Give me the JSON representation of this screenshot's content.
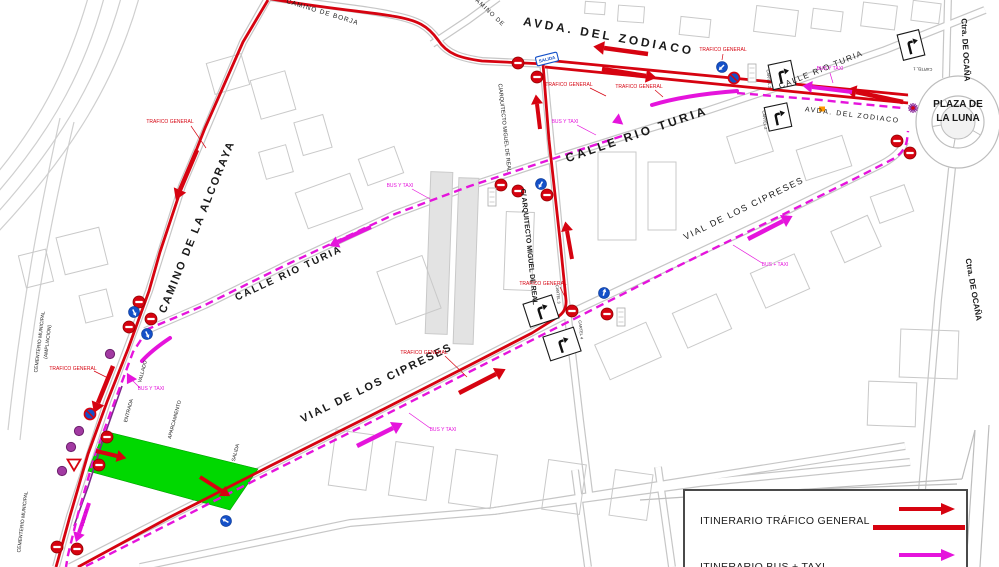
{
  "colors": {
    "red": "#d60310",
    "magenta": "#e514dc",
    "green": "#00d800",
    "purple": "#8a2a9a",
    "blue": "#1450c8",
    "black": "#1a1a1a"
  },
  "legend": {
    "general_label": "ITINERARIO TRÁFICO GENERAL",
    "bus_label": "ITINERARIO BUS + TAXI"
  },
  "street_labels": [
    {
      "t": "CAMINO DE BORJA",
      "x": 322,
      "y": 14,
      "r": 17,
      "s": 6.5,
      "ls": 1
    },
    {
      "t": "CAMINO DE",
      "x": 487,
      "y": 12,
      "r": 43,
      "s": 6,
      "ls": 1
    },
    {
      "t": "AVDA.  DEL  ZODIACO",
      "x": 608,
      "y": 40,
      "r": 10,
      "s": 12,
      "ls": 3,
      "b": 1
    },
    {
      "t": "AVDA.  DEL  ZODIACO",
      "x": 852,
      "y": 117,
      "r": 7,
      "s": 7,
      "ls": 1.5
    },
    {
      "t": "CALLE  RIO  TURIA",
      "x": 638,
      "y": 138,
      "r": -19,
      "s": 12,
      "ls": 3,
      "b": 1
    },
    {
      "t": "CALLE  RIO  TURIA",
      "x": 290,
      "y": 276,
      "r": -25,
      "s": 10,
      "ls": 2,
      "b": 1
    },
    {
      "t": "CALLE  RIO  TURIA",
      "x": 822,
      "y": 72,
      "r": -22,
      "s": 8,
      "ls": 1.5
    },
    {
      "t": "C/ARQUITECTO MIGUEL DE REAL",
      "x": 503,
      "y": 128,
      "r": 84,
      "s": 5.5
    },
    {
      "t": "C/ ARQUITECTO  MIGUEL  DE  REAL",
      "x": 527,
      "y": 247,
      "r": 84,
      "s": 7,
      "b": 1
    },
    {
      "t": "CAMINO  DE  LA  ALCORAYA",
      "x": 200,
      "y": 228,
      "r": -68,
      "s": 11,
      "ls": 2,
      "b": 1
    },
    {
      "t": "VIAL  DE  LOS  CIPRESES",
      "x": 378,
      "y": 386,
      "r": -26,
      "s": 11,
      "ls": 2,
      "b": 1
    },
    {
      "t": "VIAL  DE  LOS  CIPRESES",
      "x": 745,
      "y": 211,
      "r": -26,
      "s": 9,
      "ls": 1.5
    },
    {
      "t": "PLAZA DE",
      "x": 958,
      "y": 107,
      "s": 10,
      "b": 1
    },
    {
      "t": "LA LUNA",
      "x": 958,
      "y": 121,
      "s": 10,
      "b": 1
    },
    {
      "t": "Ctra.  DE  OCAÑA",
      "x": 963,
      "y": 50,
      "r": 87,
      "s": 8,
      "b": 1
    },
    {
      "t": "Ctra.  DE  OCAÑA",
      "x": 971,
      "y": 290,
      "r": 80,
      "s": 8,
      "b": 1
    },
    {
      "t": "CEMENTERIO MUNICIPAL",
      "x": 41,
      "y": 342,
      "r": -83,
      "s": 5
    },
    {
      "t": "(AMPLIACION)",
      "x": 49,
      "y": 342,
      "r": -83,
      "s": 5
    },
    {
      "t": "CEMENTERIO MUNICIPAL",
      "x": 24,
      "y": 522,
      "r": -83,
      "s": 5
    },
    {
      "t": "ENTRADA",
      "x": 130,
      "y": 411,
      "r": -75,
      "s": 5
    },
    {
      "t": "APARCAMIENTO",
      "x": 176,
      "y": 420,
      "r": -75,
      "s": 5
    },
    {
      "t": "SALIDA",
      "x": 237,
      "y": 453,
      "r": -75,
      "s": 5
    },
    {
      "t": "VALLADO",
      "x": 144,
      "y": 372,
      "r": -75,
      "s": 5
    },
    {
      "t": "VUELTA",
      "x": 86,
      "y": 518,
      "r": -75,
      "s": 5,
      "c": "#cc00cc"
    }
  ],
  "traffic_labels": [
    {
      "t": "TRAFICO GENERAL",
      "x": 170,
      "y": 123,
      "leader": [
        191,
        126,
        206,
        148
      ]
    },
    {
      "t": "TRAFICO GENERAL",
      "x": 569,
      "y": 86,
      "leader": [
        590,
        88,
        606,
        96
      ]
    },
    {
      "t": "TRAFICO GENERAL",
      "x": 639,
      "y": 88,
      "leader": [
        655,
        90,
        663,
        97
      ]
    },
    {
      "t": "TRAFICO GENERAL",
      "x": 723,
      "y": 51,
      "leader": [
        723,
        54,
        722,
        60
      ]
    },
    {
      "t": "TRAFICO GENERAL",
      "x": 424,
      "y": 354,
      "leader": [
        445,
        356,
        467,
        377
      ]
    },
    {
      "t": "TRAFICO GENERAL",
      "x": 543,
      "y": 285,
      "leader": [
        560,
        287,
        566,
        299
      ]
    },
    {
      "t": "TRAFICO GENERAL",
      "x": 73,
      "y": 370,
      "leader": [
        94,
        371,
        110,
        379
      ]
    }
  ],
  "bus_labels": [
    {
      "t": "BUS Y TAXI",
      "x": 565,
      "y": 123,
      "leader": [
        577,
        125,
        596,
        135
      ]
    },
    {
      "t": "BUS Y TAXI",
      "x": 400,
      "y": 187,
      "leader": [
        412,
        189,
        430,
        199
      ]
    },
    {
      "t": "BUS Y TAXI",
      "x": 151,
      "y": 390,
      "leader": [
        140,
        388,
        130,
        378
      ]
    },
    {
      "t": "BUS Y TAXI",
      "x": 443,
      "y": 431,
      "leader": [
        430,
        428,
        409,
        413
      ]
    },
    {
      "t": "BUS + TAXI",
      "x": 775,
      "y": 266,
      "leader": [
        762,
        263,
        733,
        245
      ]
    },
    {
      "t": "BUS Y TAXI",
      "x": 830,
      "y": 70,
      "leader": [
        830,
        73,
        833,
        83
      ]
    }
  ],
  "routes_red": [
    "M 266,-2 C 320,8 370,12 392,16 C 418,20 428,26 438,40 C 447,54 460,58 482,61 L 545,64",
    "M 545,60 L 908,95",
    "M 545,67 L 908,103",
    "M 268,0 L 243,42 L 205,128 L 182,186 L 160,252 L 149,291 L 128,349 L 107,402 L 88,454 L 70,516 L 58,560 L 56,567",
    "M 78,567 L 170,517 L 270,466 L 370,416 L 470,365 L 532,333 L 556,318 Q 567,312 566,300 L 560,240 L 549,140 L 543,64"
  ],
  "routes_bus": [
    "M 737,93 L 810,99 L 902,108",
    "M 622,136 L 540,163 L 470,186 L 395,214 L 290,263 L 205,305 L 148,329",
    "M 148,329 L 133,352 L 113,406 L 94,458 L 78,514 L 68,555 L 66,567",
    "M 86,566 L 175,521 L 275,470 L 375,420 L 475,369 L 560,326 L 572,320 L 670,270 L 770,221 L 862,175 L 893,159 Q 905,152 907,140 L 908,131"
  ],
  "arrows_red": [
    [
      197,
      150,
      180,
      190,
      4.5
    ],
    [
      113,
      366,
      98,
      403,
      4.5
    ],
    [
      648,
      54,
      604,
      48,
      4.5
    ],
    [
      602,
      69,
      646,
      76,
      4.5
    ],
    [
      903,
      102,
      856,
      92,
      4.5
    ],
    [
      540,
      129,
      537,
      104,
      4
    ],
    [
      572,
      259,
      567,
      231,
      4
    ],
    [
      459,
      393,
      496,
      374,
      4.5
    ],
    [
      96,
      451,
      117,
      456,
      4
    ],
    [
      200,
      477,
      222,
      491,
      4
    ]
  ],
  "arrows_bus": [
    [
      371,
      227,
      338,
      242,
      4
    ],
    [
      357,
      446,
      393,
      428,
      4.5
    ],
    [
      748,
      239,
      783,
      221,
      4.5
    ],
    [
      852,
      92,
      812,
      87,
      4
    ],
    [
      89,
      503,
      79,
      533,
      4
    ]
  ],
  "arrows_bus_curved": [
    {
      "d": "M 737,91 Q 685,95 652,105",
      "h": [
        621,
        119,
        158
      ]
    },
    {
      "d": "M 170,338 Q 152,350 142,361",
      "h": [
        132,
        376,
        122
      ]
    }
  ],
  "signs": {
    "no_entry": [
      [
        518,
        63
      ],
      [
        537,
        77
      ],
      [
        501,
        185
      ],
      [
        518,
        191
      ],
      [
        547,
        195
      ],
      [
        572,
        311
      ],
      [
        607,
        314
      ],
      [
        897,
        141
      ],
      [
        910,
        153
      ],
      [
        139,
        302
      ],
      [
        129,
        327
      ],
      [
        151,
        319
      ],
      [
        107,
        437
      ],
      [
        99,
        465
      ],
      [
        57,
        547
      ],
      [
        77,
        549
      ]
    ],
    "blue_arrow": [
      [
        722,
        67,
        225
      ],
      [
        541,
        184,
        210
      ],
      [
        604,
        293,
        15
      ],
      [
        134,
        312,
        155
      ],
      [
        147,
        334,
        155
      ],
      [
        226,
        521,
        300
      ]
    ],
    "no_parking": [
      [
        734,
        78
      ],
      [
        90,
        414
      ]
    ],
    "yield": [
      [
        74,
        464
      ]
    ],
    "purple_dot": [
      [
        110,
        354
      ],
      [
        79,
        431
      ],
      [
        71,
        447
      ],
      [
        62,
        471
      ]
    ],
    "star": [
      913,
      108
    ],
    "orange": [
      822,
      109
    ],
    "cartels": [
      {
        "x": 911,
        "y": 45,
        "w": 22,
        "h": 26,
        "r": -14,
        "label": "CARTEL 1",
        "lx": 917,
        "ly": 70,
        "lr": 182
      },
      {
        "x": 782,
        "y": 75,
        "w": 23,
        "h": 25,
        "r": -12,
        "label": "CARTEL 2",
        "lx": 767,
        "ly": 76,
        "lr": 84
      },
      {
        "x": 778,
        "y": 117,
        "w": 23,
        "h": 24,
        "r": -12,
        "label": "CARTEL 2",
        "lx": 763,
        "ly": 117,
        "lr": 84
      },
      {
        "x": 541,
        "y": 311,
        "w": 30,
        "h": 24,
        "r": -18,
        "label": "CARTEL 3",
        "lx": 561,
        "ly": 300,
        "lr": 84
      },
      {
        "x": 562,
        "y": 344,
        "w": 32,
        "h": 25,
        "r": -18,
        "label": "CARTEL 4",
        "lx": 583,
        "ly": 336,
        "lr": 84
      }
    ],
    "aux": [
      [
        492,
        197
      ],
      [
        621,
        317
      ],
      [
        752,
        73
      ]
    ],
    "salida": {
      "x": 547,
      "y": 59,
      "r": -14,
      "t": "SALIDA"
    }
  },
  "parking": {
    "polygon": "104,431 258,469 230,510 88,471",
    "color": "#00d800"
  },
  "plaza": {
    "cx": 958,
    "cy": 122,
    "rx": 42,
    "ry": 46
  },
  "background": {
    "rail": [
      "M 88,-2 C 70,60 45,115 -2,172",
      "M 104,-2 C 86,65 56,125 -2,192",
      "M 121,-2 C 101,70 66,136 -2,212",
      "M 139,-2 C 116,80 73,152 -2,232",
      "M 60,118 C 40,210 22,300 8,430",
      "M 74,122 C 52,215 34,305 20,440"
    ],
    "roads": [
      "M 985,10 L 955,22 L 885,50 L 790,83 L 700,113 L 622,137 L 540,163 L 470,186 L 395,214 L 290,263 L 205,305 L 145,331",
      "M 70,567 L 170,516 L 370,415 L 570,313 L 770,219 L 880,165 Q 900,155 905,142",
      "M 262,-4 C 330,6 372,10 392,15 C 418,20 428,26 438,40 C 447,54 462,58 482,61 L 545,64 L 908,99",
      "M 268,-2 L 243,42 L 182,186 L 149,291 L 107,402 L 70,516 L 56,567",
      "M 543,62 L 560,240 L 566,300 L 580,420 L 590,500",
      "M 432,44 L 468,20 L 498,-2",
      "M 948,-2 L 946,78",
      "M 952,168 L 938,300 L 928,420 L 922,490",
      "M 140,567 L 350,523 L 494,511 L 905,446",
      "M 494,511 L 700,483 L 910,462",
      "M 575,470 L 588,567",
      "M 658,467 L 672,567"
    ],
    "frame": [
      "M 640,500 L 962,479",
      "M 700,493 L 957,484",
      "M 975,430 L 966,567",
      "M 989,425 L 980,567",
      "M 962,479 L 975,430"
    ],
    "fence": [
      "M 122,386 L 103,440 L 88,487 L 74,526"
    ],
    "buildings": [
      [
        755,
        8,
        42,
        26,
        7
      ],
      [
        812,
        10,
        30,
        20,
        7
      ],
      [
        862,
        4,
        34,
        24,
        7
      ],
      [
        912,
        2,
        28,
        20,
        7
      ],
      [
        618,
        6,
        26,
        16,
        4
      ],
      [
        585,
        2,
        20,
        12,
        4
      ],
      [
        680,
        18,
        30,
        18,
        6
      ],
      [
        255,
        75,
        36,
        40,
        -16
      ],
      [
        298,
        118,
        30,
        34,
        -16
      ],
      [
        262,
        148,
        28,
        28,
        -16
      ],
      [
        210,
        58,
        36,
        32,
        -16
      ],
      [
        60,
        232,
        44,
        38,
        -14
      ],
      [
        22,
        252,
        28,
        33,
        -14
      ],
      [
        82,
        292,
        28,
        28,
        -14
      ],
      [
        300,
        182,
        58,
        38,
        -20
      ],
      [
        362,
        152,
        38,
        28,
        -20
      ],
      [
        428,
        172,
        22,
        162,
        2,
        "#e3e3e3"
      ],
      [
        456,
        178,
        20,
        166,
        2,
        "#e3e3e3"
      ],
      [
        505,
        212,
        28,
        78,
        2
      ],
      [
        598,
        152,
        38,
        88,
        0
      ],
      [
        648,
        162,
        28,
        68,
        0
      ],
      [
        385,
        262,
        48,
        56,
        -20
      ],
      [
        600,
        332,
        56,
        38,
        -24
      ],
      [
        678,
        302,
        48,
        38,
        -24
      ],
      [
        756,
        262,
        48,
        38,
        -24
      ],
      [
        836,
        222,
        40,
        34,
        -24
      ],
      [
        730,
        130,
        40,
        28,
        -18
      ],
      [
        800,
        142,
        48,
        32,
        -18
      ],
      [
        874,
        190,
        36,
        28,
        -20
      ],
      [
        900,
        330,
        58,
        48,
        2
      ],
      [
        868,
        382,
        48,
        44,
        2
      ],
      [
        332,
        432,
        38,
        56,
        8
      ],
      [
        392,
        444,
        38,
        54,
        8
      ],
      [
        452,
        452,
        42,
        54,
        8
      ],
      [
        545,
        462,
        38,
        50,
        8
      ],
      [
        612,
        472,
        38,
        46,
        8
      ]
    ]
  }
}
